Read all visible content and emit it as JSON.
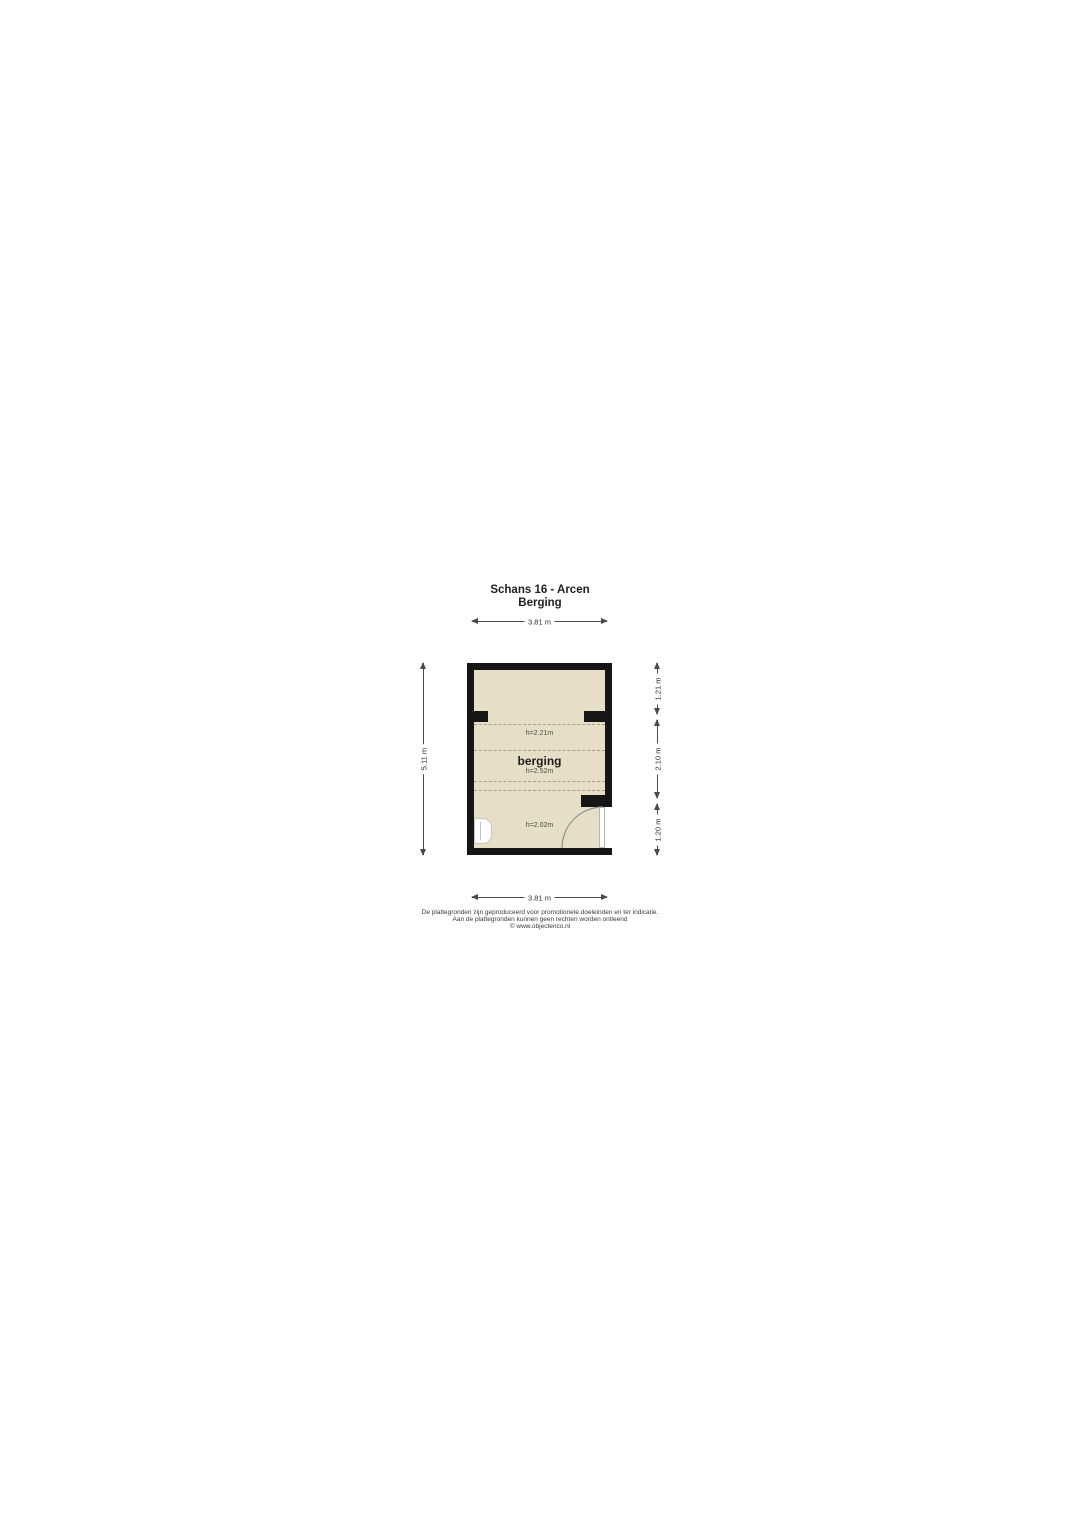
{
  "title": {
    "line1": "Schans 16 - Arcen",
    "line2": "Berging"
  },
  "room": {
    "name": "berging",
    "height_labels": {
      "top_zone": "h=2.21m",
      "main_zone": "h=2.52m",
      "bottom_zone": "h=2.02m"
    }
  },
  "dimensions": {
    "top": "3.81 m",
    "bottom": "3.81 m",
    "left": "5.11 m",
    "right_segments": [
      {
        "label": "1.21 m"
      },
      {
        "label": "2.10 m"
      },
      {
        "label": "1.20 m"
      }
    ]
  },
  "footer": {
    "line1": "De plattegronden zijn geproduceerd voor promotionele doeleinden en ter indicatie.",
    "line2": "Aan de plattegronden kunnen geen rechten worden ontleend",
    "line3": "© www.objectenco.nl"
  },
  "colors": {
    "wall": "#161616",
    "floor": "#e6dec6",
    "dashed_line": "#a89f8a",
    "dimension_line": "#4a4a4a",
    "door_arc": "#8f8f8f"
  }
}
